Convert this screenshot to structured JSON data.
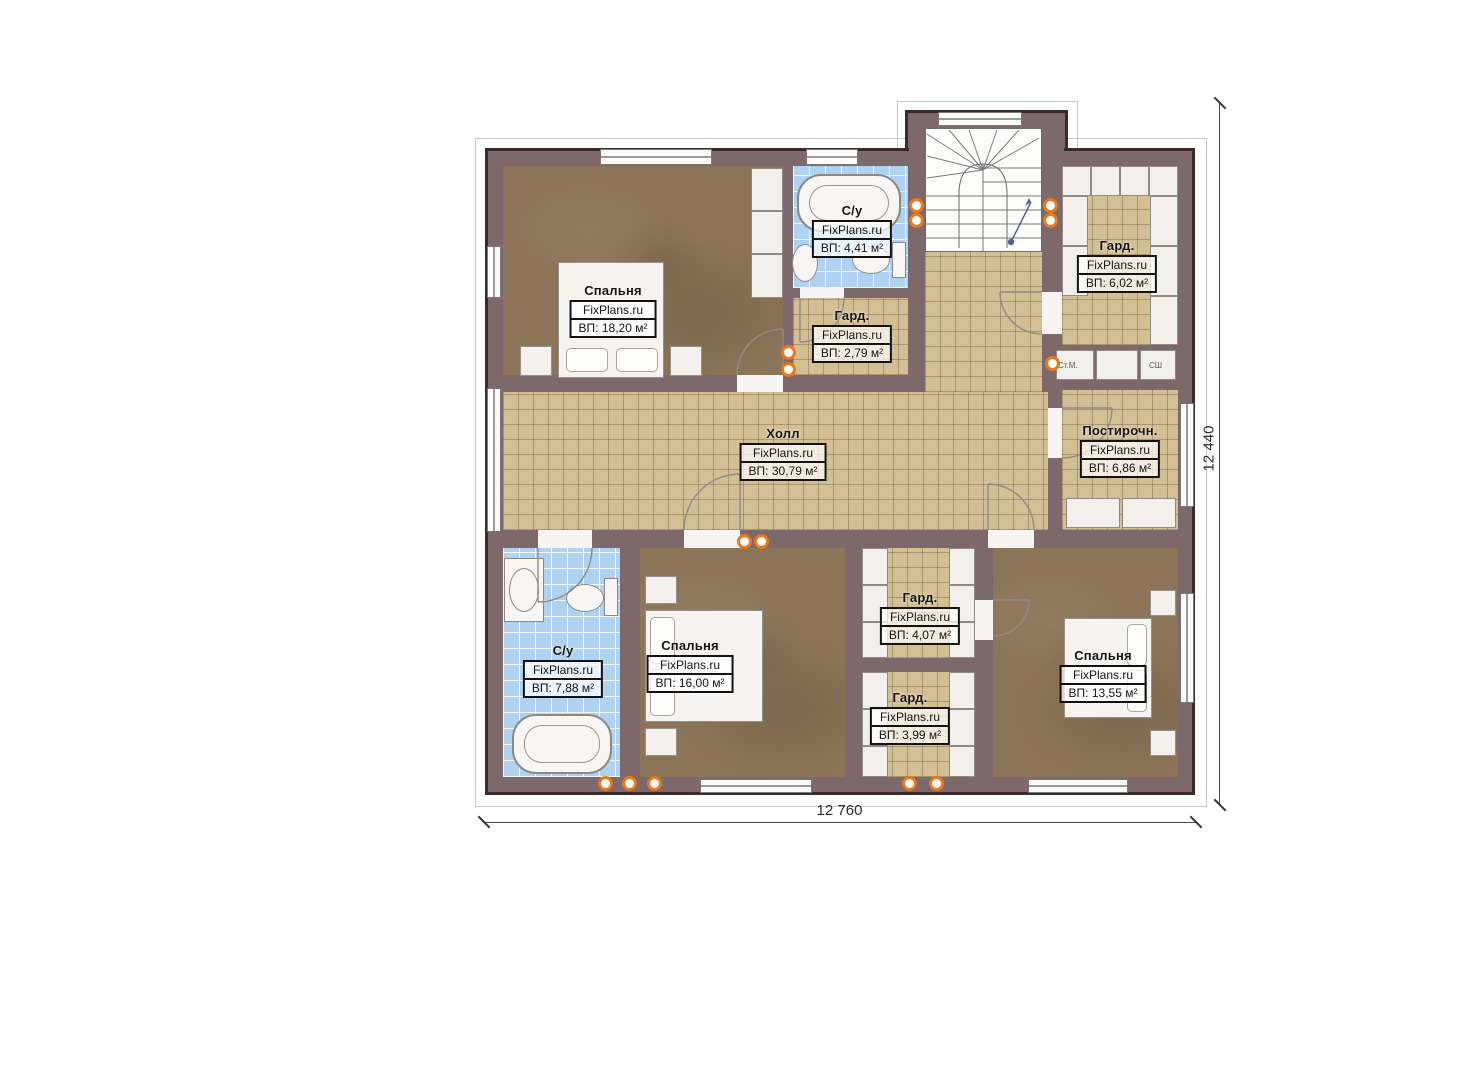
{
  "brand": "FixPlans.ru",
  "plan": {
    "dimension_width": "12 760",
    "dimension_height": "12 440"
  },
  "rooms": [
    {
      "id": "bedroom-top-left",
      "name": "Спальня",
      "area": "ВП: 18,20 м²"
    },
    {
      "id": "bathroom-top",
      "name": "С/у",
      "area": "ВП: 4,41 м²"
    },
    {
      "id": "wardrobe-top",
      "name": "Гард.",
      "area": "ВП: 2,79 м²"
    },
    {
      "id": "wardrobe-right",
      "name": "Гард.",
      "area": "ВП: 6,02 м²"
    },
    {
      "id": "hall",
      "name": "Холл",
      "area": "ВП: 30,79 м²"
    },
    {
      "id": "laundry",
      "name": "Постирочн.",
      "area": "ВП: 6,86 м²"
    },
    {
      "id": "bathroom-bottom",
      "name": "С/у",
      "area": "ВП: 7,88 м²"
    },
    {
      "id": "bedroom-bottom-middle",
      "name": "Спальня",
      "area": "ВП: 16,00 м²"
    },
    {
      "id": "wardrobe-middle-upper",
      "name": "Гард.",
      "area": "ВП: 4,07 м²"
    },
    {
      "id": "wardrobe-middle-lower",
      "name": "Гард.",
      "area": "ВП: 3,99 м²"
    },
    {
      "id": "bedroom-bottom-right",
      "name": "Спальня",
      "area": "ВП: 13,55 м²"
    }
  ],
  "appliances": {
    "washer": "Ст.М.",
    "dryer": "СШ"
  },
  "colors": {
    "wall": "#7d696b",
    "tile_floor": "#d3bf94",
    "bath_tile": "#aed2ef",
    "wood_floor": "#8b7457",
    "marker_accent": "#e8791d"
  }
}
